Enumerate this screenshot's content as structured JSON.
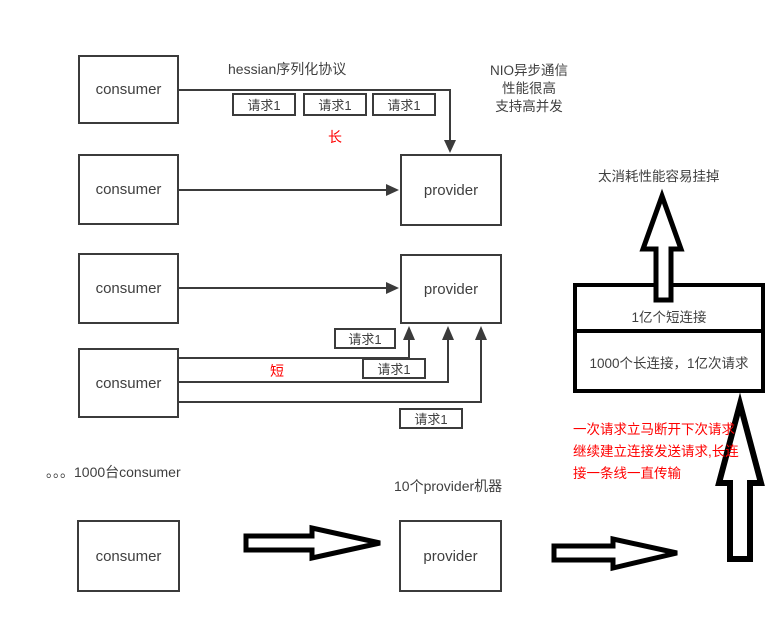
{
  "labels": {
    "consumer": "consumer",
    "provider": "provider",
    "request": "请求1"
  },
  "annotations": {
    "hessian_protocol": "hessian序列化协议",
    "nio_lines": [
      "NIO异步通信",
      "性能很高",
      "支持高并发"
    ],
    "long_tag": "长",
    "short_tag": "短",
    "overload_note": "太消耗性能容易挂掉",
    "short_connections": "1亿个短连接",
    "long_connections": "1000个长连接，1亿次请求",
    "red_note_lines": [
      "一次请求立马断开下次请求",
      "继续建立连接发送请求,长连",
      "接一条线一直传输"
    ],
    "consumer_scale": "。。。1000台consumer",
    "provider_scale": "10个provider机器"
  },
  "colors": {
    "box_border": "#3b3b3b",
    "text": "#3f3f3f",
    "accent_red": "#ff0000",
    "bold_arrow": "#000000"
  }
}
